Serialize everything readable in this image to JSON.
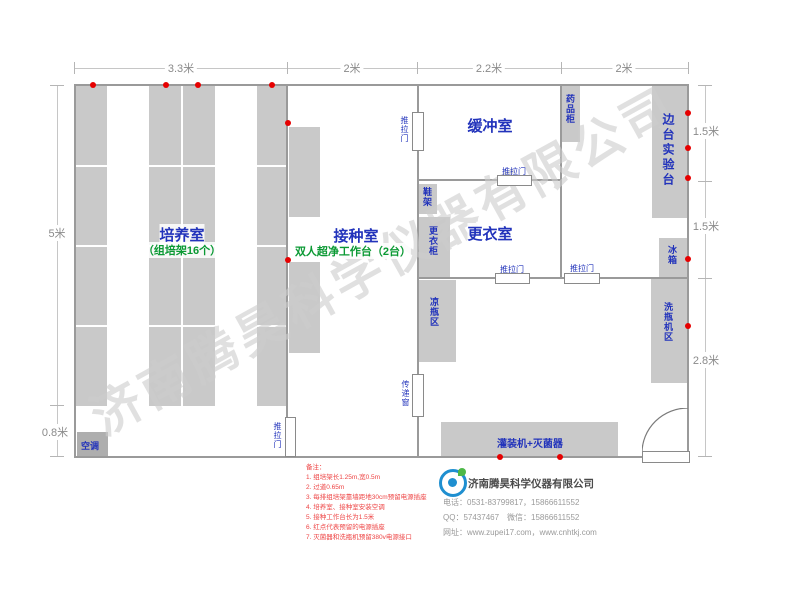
{
  "dims": {
    "top": [
      "3.3米",
      "2米",
      "2.2米",
      "2米"
    ],
    "left": [
      "5米",
      "0.8米"
    ],
    "right": [
      "1.5米",
      "1.5米",
      "2.8米"
    ]
  },
  "rooms": {
    "cultivation": {
      "name": "培养室",
      "sub": "（组培架16个）"
    },
    "inoculation": {
      "name": "接种室",
      "sub": "双人超净工作台（2台）"
    },
    "buffer": {
      "name": "缓冲室"
    },
    "changing": {
      "name": "更衣室"
    },
    "side_bench": {
      "name": "边台实验台"
    }
  },
  "fixtures": {
    "ac": "空调",
    "medicine_cabinet": "药品柜",
    "fridge": "冰箱",
    "washer_area": "洗瓶机区",
    "shoe_rack": "鞋架",
    "locker": "更衣柜",
    "cool_bottle_area": "凉瓶区",
    "transfer_window": "传递窗",
    "filler": "灌装机+灭菌器",
    "sliding_door": "推拉门"
  },
  "watermark": "济南腾昊科学仪器有限公司",
  "notes": {
    "title": "备注：",
    "items": [
      "1. 组培架长1.25m,宽0.5m",
      "2. 过道0.65m",
      "3. 每排组培架靠墙距地30cm预留电源插座",
      "4. 培养室、接种室安装空调",
      "5. 接种工作台长为1.5米",
      "6. 红点代表预留的电源插座",
      "7. 灭菌器和洗瓶机预留380v电源接口"
    ]
  },
  "footer": {
    "company": "济南腾昊科学仪器有限公司",
    "phone": "电话：0531-83799817，15866611552",
    "qq": "QQ：57437467　微信：15866611552",
    "web": "网址：www.zupei17.com，www.cnhtkj.com"
  },
  "colors": {
    "accent_blue": "#2233bb",
    "accent_green": "#0a9933",
    "power_dot_red": "#e60000",
    "note_red": "#ee4444"
  }
}
